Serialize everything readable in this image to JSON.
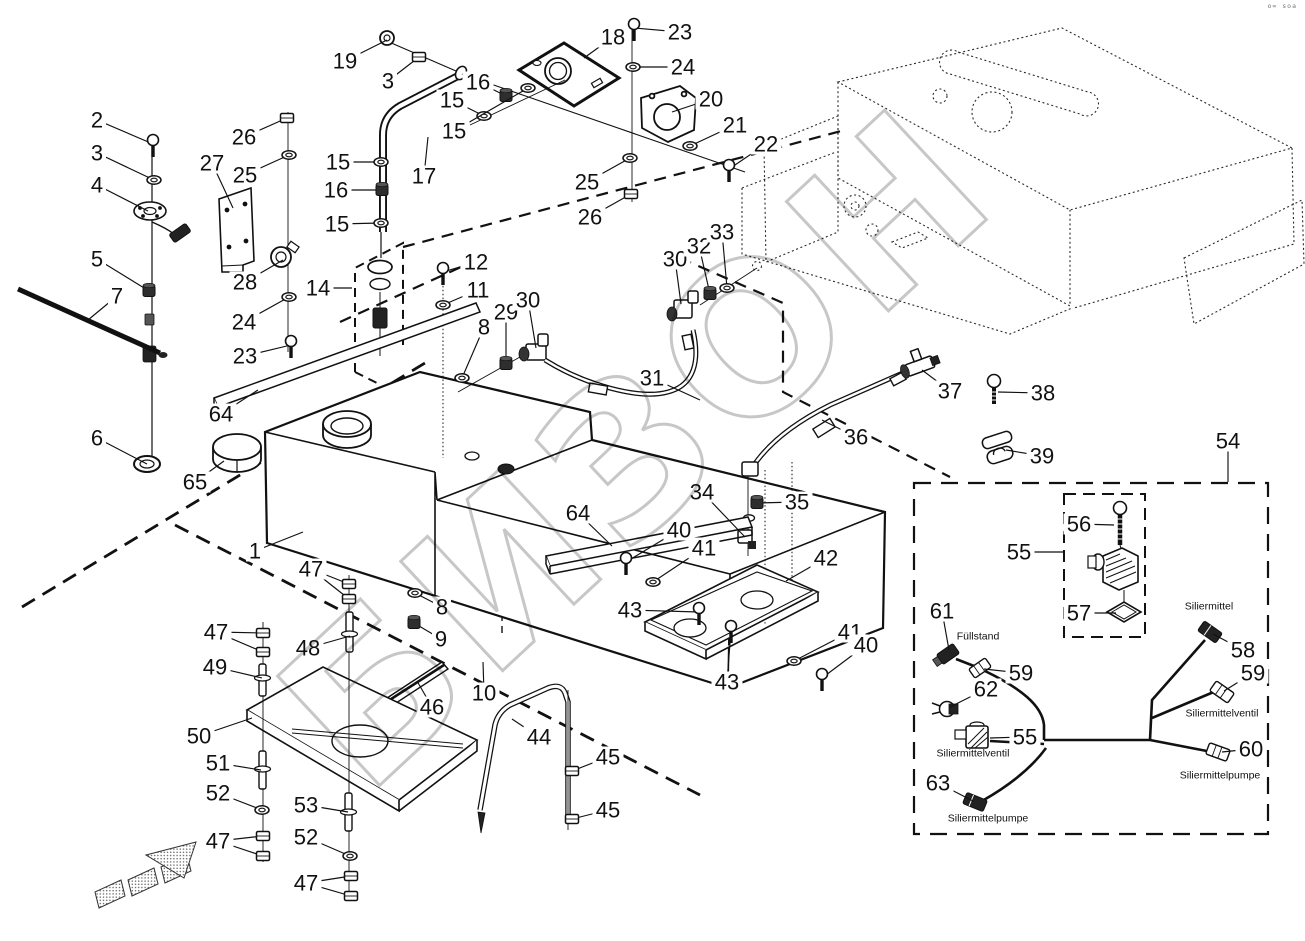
{
  "watermark": {
    "text": "БИЗОН",
    "color": "#c7c7c7"
  },
  "corner_mark": "o= soa",
  "labels": [
    {
      "id": "fuellstand",
      "text": "Füllstand",
      "x": 978,
      "y": 636
    },
    {
      "id": "siliermittel",
      "text": "Siliermittel",
      "x": 1209,
      "y": 606
    },
    {
      "id": "siliermittelventil-r",
      "text": "Siliermittelventil",
      "x": 1222,
      "y": 713
    },
    {
      "id": "siliermittelventil-l",
      "text": "Siliermittelventil",
      "x": 973,
      "y": 753
    },
    {
      "id": "siliermittelpumpe-r",
      "text": "Siliermittelpumpe",
      "x": 1220,
      "y": 775
    },
    {
      "id": "siliermittelpumpe-l",
      "text": "Siliermittelpumpe",
      "x": 988,
      "y": 818
    }
  ],
  "callouts": [
    {
      "n": "2",
      "x": 97,
      "y": 120,
      "t": [
        [
          153,
          144
        ]
      ],
      "k": "screw"
    },
    {
      "n": "3",
      "x": 97,
      "y": 153,
      "t": [
        [
          154,
          180
        ]
      ],
      "k": "washer"
    },
    {
      "n": "4",
      "x": 97,
      "y": 185,
      "t": [
        [
          148,
          211
        ]
      ],
      "k": "none"
    },
    {
      "n": "5",
      "x": 97,
      "y": 259,
      "t": [
        [
          149,
          291
        ]
      ],
      "k": "fitting"
    },
    {
      "n": "7",
      "x": 117,
      "y": 296,
      "t": [
        [
          88,
          320
        ]
      ],
      "k": "none"
    },
    {
      "n": "6",
      "x": 97,
      "y": 438,
      "t": [
        [
          147,
          464
        ]
      ],
      "k": "none"
    },
    {
      "n": "19",
      "x": 345,
      "y": 61,
      "t": [
        [
          387,
          40
        ]
      ],
      "k": "none"
    },
    {
      "n": "3",
      "x": 388,
      "y": 81,
      "t": [
        [
          419,
          57
        ]
      ],
      "k": "nut"
    },
    {
      "n": "26",
      "x": 244,
      "y": 137,
      "t": [
        [
          287,
          118
        ]
      ],
      "k": "nut"
    },
    {
      "n": "25",
      "x": 245,
      "y": 175,
      "t": [
        [
          289,
          155
        ]
      ],
      "k": "washer"
    },
    {
      "n": "27",
      "x": 212,
      "y": 163,
      "t": [
        [
          233,
          208
        ]
      ],
      "k": "none"
    },
    {
      "n": "28",
      "x": 245,
      "y": 282,
      "t": [
        [
          283,
          260
        ]
      ],
      "k": "none"
    },
    {
      "n": "24",
      "x": 244,
      "y": 322,
      "t": [
        [
          289,
          297
        ]
      ],
      "k": "washer"
    },
    {
      "n": "23",
      "x": 245,
      "y": 356,
      "t": [
        [
          291,
          345
        ]
      ],
      "k": "screw"
    },
    {
      "n": "15",
      "x": 338,
      "y": 162,
      "t": [
        [
          381,
          162
        ]
      ],
      "k": "washer"
    },
    {
      "n": "16",
      "x": 336,
      "y": 190,
      "t": [
        [
          382,
          190
        ]
      ],
      "k": "fitting"
    },
    {
      "n": "15",
      "x": 337,
      "y": 224,
      "t": [
        [
          381,
          223
        ]
      ],
      "k": "washer"
    },
    {
      "n": "17",
      "x": 424,
      "y": 176,
      "t": [
        [
          428,
          137
        ]
      ],
      "k": "none"
    },
    {
      "n": "14",
      "x": 318,
      "y": 288,
      "t": [
        [
          352,
          288
        ]
      ],
      "k": "none"
    },
    {
      "n": "18",
      "x": 613,
      "y": 37,
      "t": [
        [
          584,
          58
        ]
      ],
      "k": "none"
    },
    {
      "n": "23",
      "x": 680,
      "y": 32,
      "t": [
        [
          634,
          28
        ]
      ],
      "k": "screw"
    },
    {
      "n": "24",
      "x": 683,
      "y": 67,
      "t": [
        [
          633,
          67
        ]
      ],
      "k": "washer"
    },
    {
      "n": "16",
      "x": 478,
      "y": 82,
      "t": [
        [
          506,
          96
        ]
      ],
      "k": "fitting"
    },
    {
      "n": "15",
      "x": 452,
      "y": 100,
      "t": [
        [
          484,
          116
        ]
      ],
      "k": "washer"
    },
    {
      "n": "15",
      "x": 454,
      "y": 131,
      "t": [
        [
          528,
          88
        ]
      ],
      "k": "washer"
    },
    {
      "n": "20",
      "x": 711,
      "y": 99,
      "t": [
        [
          672,
          112
        ]
      ],
      "k": "none"
    },
    {
      "n": "21",
      "x": 735,
      "y": 125,
      "t": [
        [
          690,
          146
        ]
      ],
      "k": "washer"
    },
    {
      "n": "22",
      "x": 766,
      "y": 144,
      "t": [
        [
          729,
          169
        ]
      ],
      "k": "screw"
    },
    {
      "n": "25",
      "x": 587,
      "y": 182,
      "t": [
        [
          630,
          158
        ]
      ],
      "k": "washer"
    },
    {
      "n": "26",
      "x": 590,
      "y": 217,
      "t": [
        [
          631,
          194
        ]
      ],
      "k": "nut"
    },
    {
      "n": "12",
      "x": 476,
      "y": 262,
      "t": [
        [
          443,
          272
        ]
      ],
      "k": "screw"
    },
    {
      "n": "11",
      "x": 478,
      "y": 290,
      "t": [
        [
          443,
          305
        ]
      ],
      "k": "washer"
    },
    {
      "n": "8",
      "x": 484,
      "y": 327,
      "t": [
        [
          462,
          378
        ]
      ],
      "k": "washer"
    },
    {
      "n": "29",
      "x": 506,
      "y": 312,
      "t": [
        [
          506,
          364
        ]
      ],
      "k": "fitting"
    },
    {
      "n": "30",
      "x": 528,
      "y": 300,
      "t": [
        [
          536,
          348
        ]
      ],
      "k": "none"
    },
    {
      "n": "30",
      "x": 675,
      "y": 259,
      "t": [
        [
          681,
          304
        ]
      ],
      "k": "none"
    },
    {
      "n": "32",
      "x": 699,
      "y": 246,
      "t": [
        [
          710,
          294
        ]
      ],
      "k": "fitting"
    },
    {
      "n": "33",
      "x": 722,
      "y": 232,
      "t": [
        [
          727,
          288
        ]
      ],
      "k": "washer"
    },
    {
      "n": "31",
      "x": 652,
      "y": 378,
      "t": [
        [
          700,
          400
        ]
      ],
      "k": "none"
    },
    {
      "n": "34",
      "x": 702,
      "y": 492,
      "t": [
        [
          745,
          537
        ]
      ],
      "k": "none"
    },
    {
      "n": "35",
      "x": 797,
      "y": 502,
      "t": [
        [
          757,
          503
        ]
      ],
      "k": "fitting"
    },
    {
      "n": "36",
      "x": 856,
      "y": 437,
      "t": [
        [
          822,
          420
        ]
      ],
      "k": "none"
    },
    {
      "n": "37",
      "x": 950,
      "y": 391,
      "t": [
        [
          922,
          370
        ]
      ],
      "k": "none"
    },
    {
      "n": "38",
      "x": 1043,
      "y": 393,
      "t": [
        [
          998,
          392
        ]
      ],
      "k": "none"
    },
    {
      "n": "39",
      "x": 1042,
      "y": 456,
      "t": [
        [
          1006,
          450
        ]
      ],
      "k": "none"
    },
    {
      "n": "54",
      "x": 1228,
      "y": 441,
      "t": [
        [
          1228,
          482
        ]
      ],
      "k": "none"
    },
    {
      "n": "64",
      "x": 221,
      "y": 414,
      "t": [
        [
          258,
          390
        ]
      ],
      "k": "none"
    },
    {
      "n": "65",
      "x": 195,
      "y": 482,
      "t": [
        [
          224,
          461
        ]
      ],
      "k": "none"
    },
    {
      "n": "1",
      "x": 255,
      "y": 551,
      "t": [
        [
          303,
          532
        ]
      ],
      "k": "none"
    },
    {
      "n": "64",
      "x": 578,
      "y": 513,
      "t": [
        [
          612,
          546
        ]
      ],
      "k": "none"
    },
    {
      "n": "40",
      "x": 679,
      "y": 530,
      "t": [
        [
          626,
          562
        ]
      ],
      "k": "screw"
    },
    {
      "n": "41",
      "x": 704,
      "y": 548,
      "t": [
        [
          653,
          582
        ]
      ],
      "k": "washer"
    },
    {
      "n": "42",
      "x": 826,
      "y": 558,
      "t": [
        [
          786,
          581
        ]
      ],
      "k": "none"
    },
    {
      "n": "43",
      "x": 630,
      "y": 610,
      "t": [
        [
          699,
          612
        ]
      ],
      "k": "screw"
    },
    {
      "n": "43",
      "x": 727,
      "y": 682,
      "t": [
        [
          731,
          630
        ]
      ],
      "k": "screw"
    },
    {
      "n": "41",
      "x": 850,
      "y": 632,
      "t": [
        [
          794,
          661
        ]
      ],
      "k": "washer"
    },
    {
      "n": "40",
      "x": 866,
      "y": 645,
      "t": [
        [
          822,
          678
        ]
      ],
      "k": "screw"
    },
    {
      "n": "8",
      "x": 442,
      "y": 607,
      "t": [
        [
          415,
          593
        ]
      ],
      "k": "washer"
    },
    {
      "n": "9",
      "x": 441,
      "y": 639,
      "t": [
        [
          414,
          623
        ]
      ],
      "k": "fitting"
    },
    {
      "n": "47",
      "x": 216,
      "y": 632,
      "t": [
        [
          263,
          633
        ],
        [
          263,
          652
        ]
      ],
      "k": "nut2"
    },
    {
      "n": "47",
      "x": 311,
      "y": 569,
      "t": [
        [
          349,
          584
        ],
        [
          349,
          599
        ]
      ],
      "k": "nut2"
    },
    {
      "n": "48",
      "x": 308,
      "y": 648,
      "t": [
        [
          350,
          636
        ]
      ],
      "k": "none"
    },
    {
      "n": "49",
      "x": 215,
      "y": 667,
      "t": [
        [
          262,
          678
        ]
      ],
      "k": "none"
    },
    {
      "n": "50",
      "x": 199,
      "y": 736,
      "t": [
        [
          252,
          718
        ]
      ],
      "k": "none"
    },
    {
      "n": "51",
      "x": 218,
      "y": 763,
      "t": [
        [
          261,
          770
        ]
      ],
      "k": "none"
    },
    {
      "n": "52",
      "x": 218,
      "y": 793,
      "t": [
        [
          262,
          810
        ]
      ],
      "k": "washer"
    },
    {
      "n": "47",
      "x": 218,
      "y": 841,
      "t": [
        [
          263,
          836
        ],
        [
          263,
          856
        ]
      ],
      "k": "nut2"
    },
    {
      "n": "53",
      "x": 306,
      "y": 805,
      "t": [
        [
          348,
          812
        ]
      ],
      "k": "none"
    },
    {
      "n": "52",
      "x": 306,
      "y": 837,
      "t": [
        [
          350,
          856
        ]
      ],
      "k": "washer"
    },
    {
      "n": "47",
      "x": 306,
      "y": 883,
      "t": [
        [
          351,
          876
        ],
        [
          351,
          896
        ]
      ],
      "k": "nut2"
    },
    {
      "n": "10",
      "x": 484,
      "y": 693,
      "t": [
        [
          483,
          662
        ]
      ],
      "k": "none"
    },
    {
      "n": "46",
      "x": 432,
      "y": 707,
      "t": [
        [
          417,
          681
        ]
      ],
      "k": "none"
    },
    {
      "n": "44",
      "x": 539,
      "y": 737,
      "t": [
        [
          512,
          719
        ]
      ],
      "k": "none"
    },
    {
      "n": "45",
      "x": 608,
      "y": 757,
      "t": [
        [
          572,
          771
        ]
      ],
      "k": "nut"
    },
    {
      "n": "45",
      "x": 608,
      "y": 810,
      "t": [
        [
          572,
          819
        ]
      ],
      "k": "nut"
    },
    {
      "n": "56",
      "x": 1079,
      "y": 524,
      "t": [
        [
          1114,
          525
        ]
      ],
      "k": "none"
    },
    {
      "n": "55",
      "x": 1019,
      "y": 552,
      "t": [
        [
          1063,
          552
        ]
      ],
      "k": "none"
    },
    {
      "n": "57",
      "x": 1079,
      "y": 613,
      "t": [
        [
          1116,
          613
        ]
      ],
      "k": "none"
    },
    {
      "n": "61",
      "x": 942,
      "y": 611,
      "t": [
        [
          949,
          650
        ]
      ],
      "k": "none"
    },
    {
      "n": "59",
      "x": 1021,
      "y": 673,
      "t": [
        [
          984,
          669
        ]
      ],
      "k": "none"
    },
    {
      "n": "62",
      "x": 986,
      "y": 689,
      "t": [
        [
          950,
          707
        ]
      ],
      "k": "none"
    },
    {
      "n": "55",
      "x": 1025,
      "y": 737,
      "t": [
        [
          990,
          738
        ]
      ],
      "k": "none"
    },
    {
      "n": "58",
      "x": 1243,
      "y": 650,
      "t": [
        [
          1213,
          634
        ]
      ],
      "k": "none"
    },
    {
      "n": "59",
      "x": 1253,
      "y": 673,
      "t": [
        [
          1224,
          691
        ]
      ],
      "k": "none"
    },
    {
      "n": "60",
      "x": 1251,
      "y": 749,
      "t": [
        [
          1222,
          752
        ]
      ],
      "k": "none"
    },
    {
      "n": "63",
      "x": 938,
      "y": 783,
      "t": [
        [
          973,
          801
        ]
      ],
      "k": "none"
    }
  ]
}
